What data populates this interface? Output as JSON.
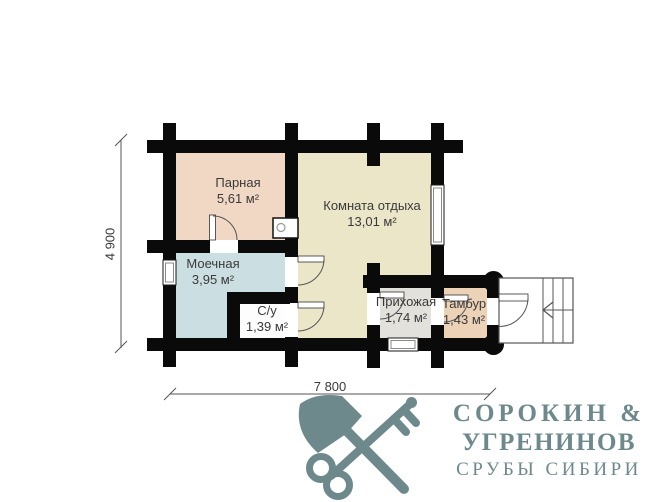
{
  "plan": {
    "rooms": [
      {
        "id": "parnaya",
        "name": "Парная",
        "area": "5,61 м²",
        "color": "#f1d8c5"
      },
      {
        "id": "komnata-otdyha",
        "name": "Комната отдыха",
        "area": "13,01 м²",
        "color": "#ebe6c8"
      },
      {
        "id": "moechnaya",
        "name": "Моечная",
        "area": "3,95 м²",
        "color": "#cbdee2"
      },
      {
        "id": "su",
        "name": "С/у",
        "area": "1,39 м²",
        "color": "#fdfdfd"
      },
      {
        "id": "prihozhaya",
        "name": "Прихожая",
        "area": "1,74 м²",
        "color": "#e3e1db"
      },
      {
        "id": "tambur",
        "name": "Тамбур",
        "area": "1,43 м²",
        "color": "#ecd2b7"
      }
    ],
    "dimensions": {
      "width_label": "7 800",
      "height_label": "4 900"
    },
    "wall_color": "#0a0a0a"
  },
  "logo": {
    "line1": "СОРОКИН &",
    "line2": "УГРЕНИНОВ",
    "line3": "СРУБЫ СИБИРИ",
    "color": "#6d898c",
    "icon": "axe-and-key"
  }
}
